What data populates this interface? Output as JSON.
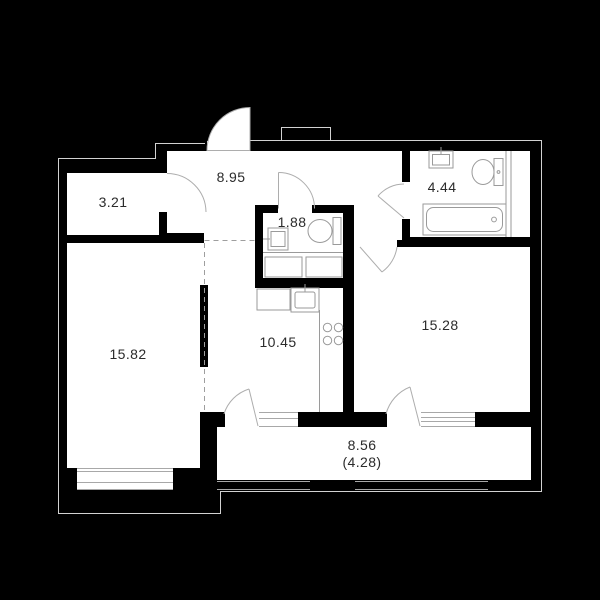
{
  "colors": {
    "background": "#000000",
    "walls": "#000000",
    "floor": "#ffffff",
    "label": "#2b2b2b",
    "fixture_line": "#9a9a9a"
  },
  "rooms": {
    "wardrobe": {
      "area": "3.21"
    },
    "hallway": {
      "area": "8.95"
    },
    "bathroom": {
      "area": "4.44"
    },
    "wc": {
      "area": "1.88"
    },
    "bedroom": {
      "area": "15.82"
    },
    "kitchen": {
      "area": "10.45"
    },
    "living_room": {
      "area": "15.28"
    },
    "balcony": {
      "area": "8.56",
      "area_reduced": "(4.28)"
    }
  }
}
